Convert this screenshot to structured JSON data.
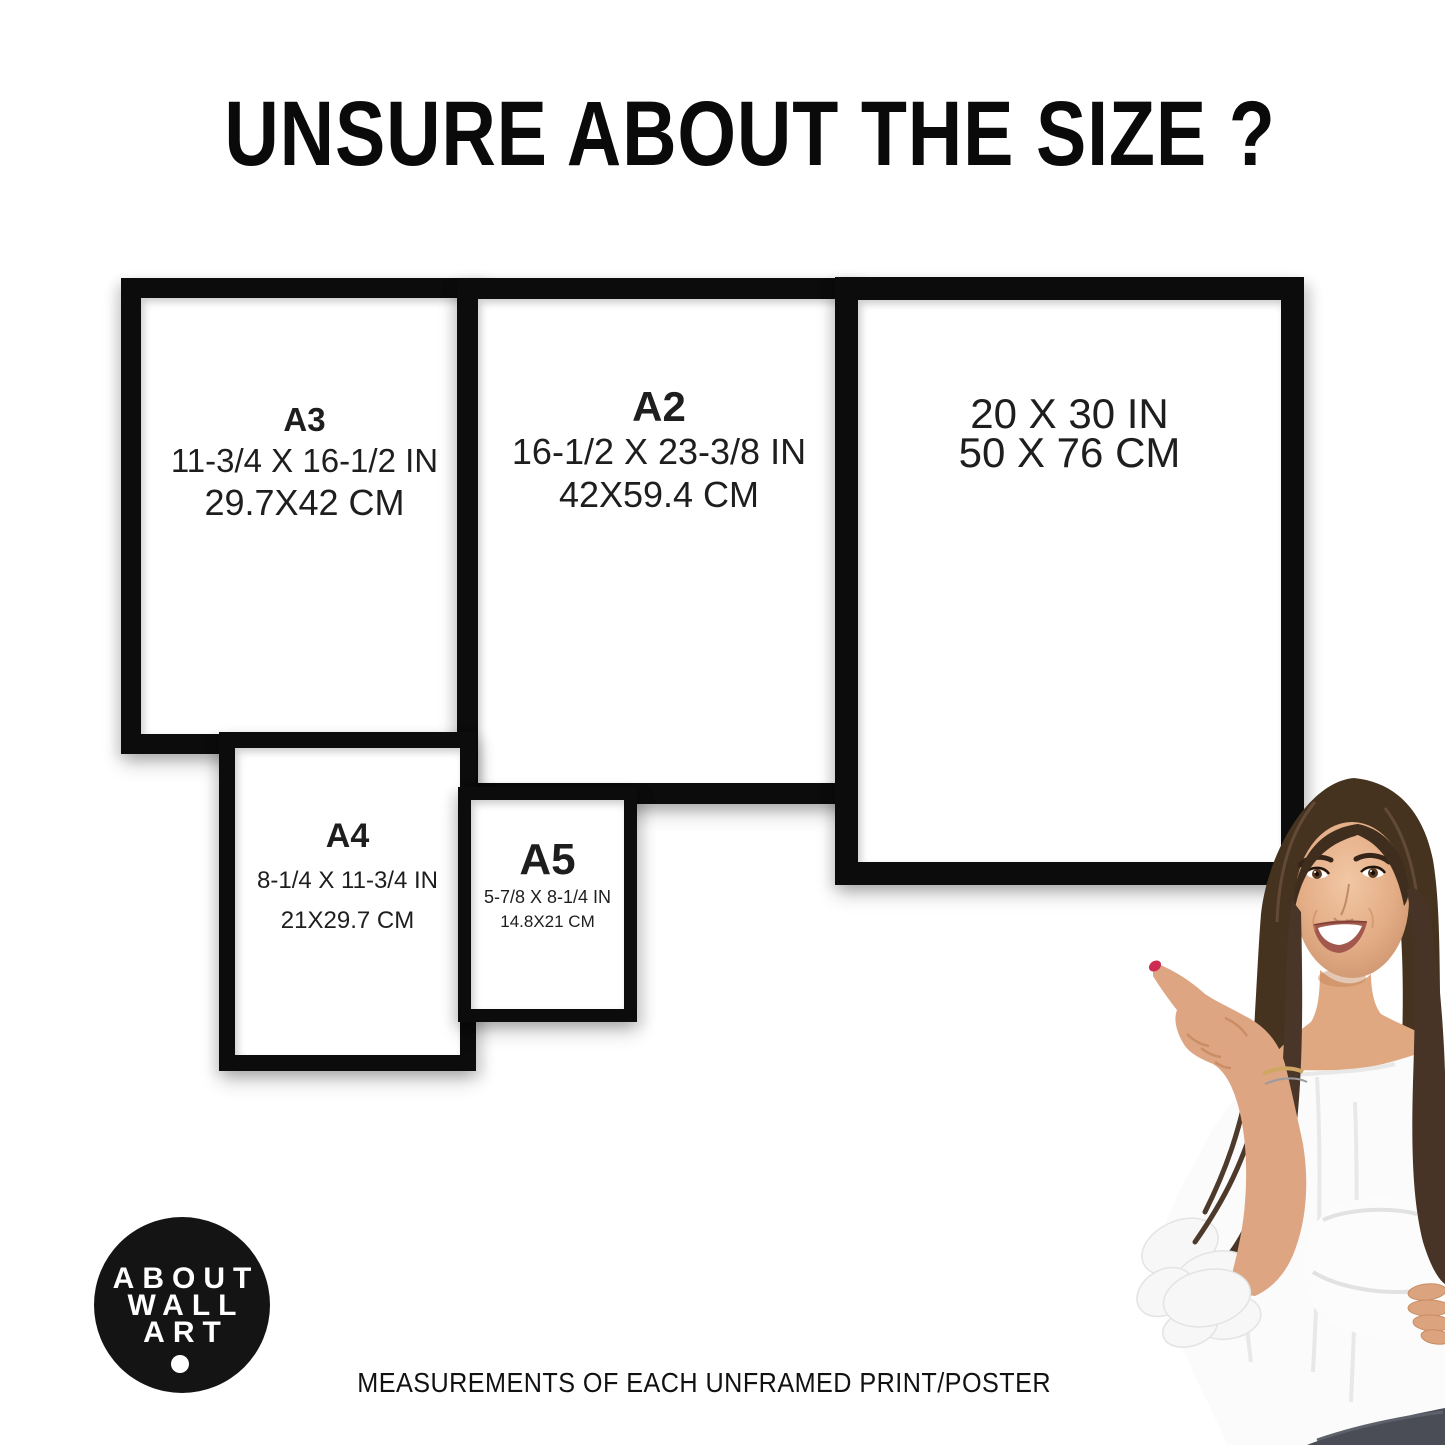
{
  "title": "UNSURE ABOUT THE SIZE ?",
  "caption": "MEASUREMENTS OF EACH UNFRAMED PRINT/POSTER",
  "logo": {
    "lines": [
      "ABOUT",
      "WALL",
      "ART"
    ]
  },
  "frames": [
    {
      "id": "a3",
      "label": "A3",
      "inches": "11-3/4 X 16-1/2 IN",
      "cm": "29.7X42 CM"
    },
    {
      "id": "a2",
      "label": "A2",
      "inches": "16-1/2 X 23-3/8 IN",
      "cm": "42X59.4 CM"
    },
    {
      "id": "20x30",
      "label": "",
      "inches": "20 X 30 IN",
      "cm": "50 X 76 CM"
    },
    {
      "id": "a4",
      "label": "A4",
      "inches": "8-1/4 X 11-3/4 IN",
      "cm": "21X29.7 CM"
    },
    {
      "id": "a5",
      "label": "A5",
      "inches": "5-7/8 X 8-1/4 IN",
      "cm": "14.8X21 CM"
    }
  ],
  "colors": {
    "frame_black": "#0c0c0c",
    "text": "#1d1d1d",
    "logo_bg": "#141414",
    "nail_red": "#cd2b52",
    "hair_brown": "#46331f",
    "skin_tan": "#dda581",
    "blouse_white": "#fbfbfb",
    "jeans_gray": "#4a4d55"
  }
}
